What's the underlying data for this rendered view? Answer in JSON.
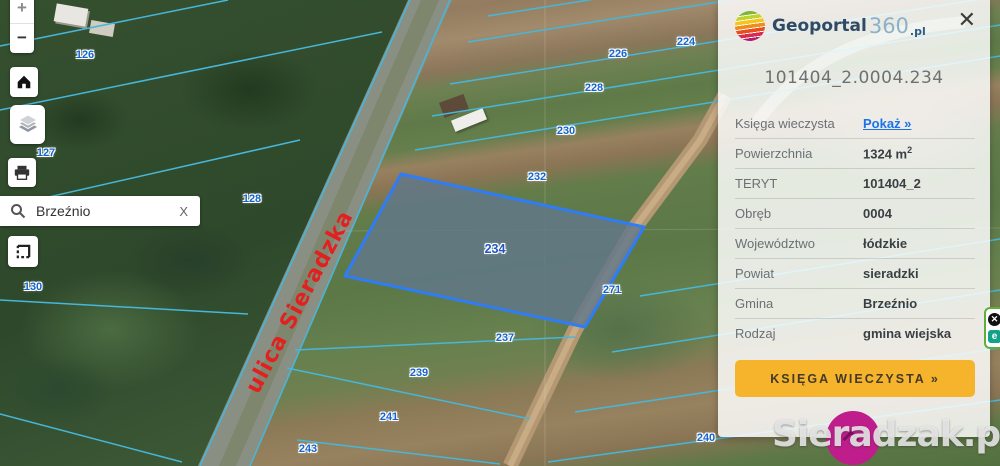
{
  "app": {
    "name": "Geoportal360.pl"
  },
  "panel": {
    "logo": {
      "text_main": "Geoportal",
      "text_360": "360",
      "text_pl": ".pl"
    },
    "close_icon": "✕",
    "title": "101404_2.0004.234",
    "rows": [
      {
        "label": "Księga wieczysta",
        "value": "Pokaż »",
        "type": "link"
      },
      {
        "label": "Powierzchnia",
        "value": "1324 m",
        "sup": "2"
      },
      {
        "label": "TERYT",
        "value": "101404_2"
      },
      {
        "label": "Obręb",
        "value": "0004"
      },
      {
        "label": "Województwo",
        "value": "łódzkie"
      },
      {
        "label": "Powiat",
        "value": "sieradzki"
      },
      {
        "label": "Gmina",
        "value": "Brzeźnio"
      },
      {
        "label": "Rodzaj",
        "value": "gmina wiejska"
      }
    ],
    "button_label": "KSIĘGA WIECZYSTA »"
  },
  "toolbar": {
    "zoom_in": "+",
    "zoom_out": "−",
    "search": {
      "value": "Brzeźnio",
      "clear_label": "X"
    }
  },
  "map": {
    "street_label": "ulica Sieradzka",
    "selected_parcel": "234",
    "labels": [
      {
        "text": "126",
        "x": 85,
        "y": 55
      },
      {
        "text": "127",
        "x": 46,
        "y": 153
      },
      {
        "text": "128",
        "x": 252,
        "y": 199
      },
      {
        "text": "130",
        "x": 33,
        "y": 287
      },
      {
        "text": "224",
        "x": 686,
        "y": 42
      },
      {
        "text": "226",
        "x": 618,
        "y": 54
      },
      {
        "text": "228",
        "x": 594,
        "y": 88
      },
      {
        "text": "230",
        "x": 566,
        "y": 131
      },
      {
        "text": "232",
        "x": 537,
        "y": 177
      },
      {
        "text": "234",
        "x": 495,
        "y": 249,
        "selected": true
      },
      {
        "text": "271",
        "x": 612,
        "y": 290
      },
      {
        "text": "237",
        "x": 505,
        "y": 338
      },
      {
        "text": "239",
        "x": 419,
        "y": 373
      },
      {
        "text": "241",
        "x": 389,
        "y": 417
      },
      {
        "text": "243",
        "x": 308,
        "y": 449
      },
      {
        "text": "240",
        "x": 706,
        "y": 438
      }
    ],
    "colors": {
      "boundary_line": "#46b7da",
      "selected_parcel_stroke": "#2e7df5",
      "street_label": "#e32020",
      "link": "#1a73e8",
      "panel_button_bg": "#f6b42c",
      "watermark_circle": "#bf1d8c"
    }
  },
  "watermark": {
    "text": "Sieradzak.pl"
  },
  "widget": {
    "close_icon": "✕",
    "e_label": "e"
  }
}
